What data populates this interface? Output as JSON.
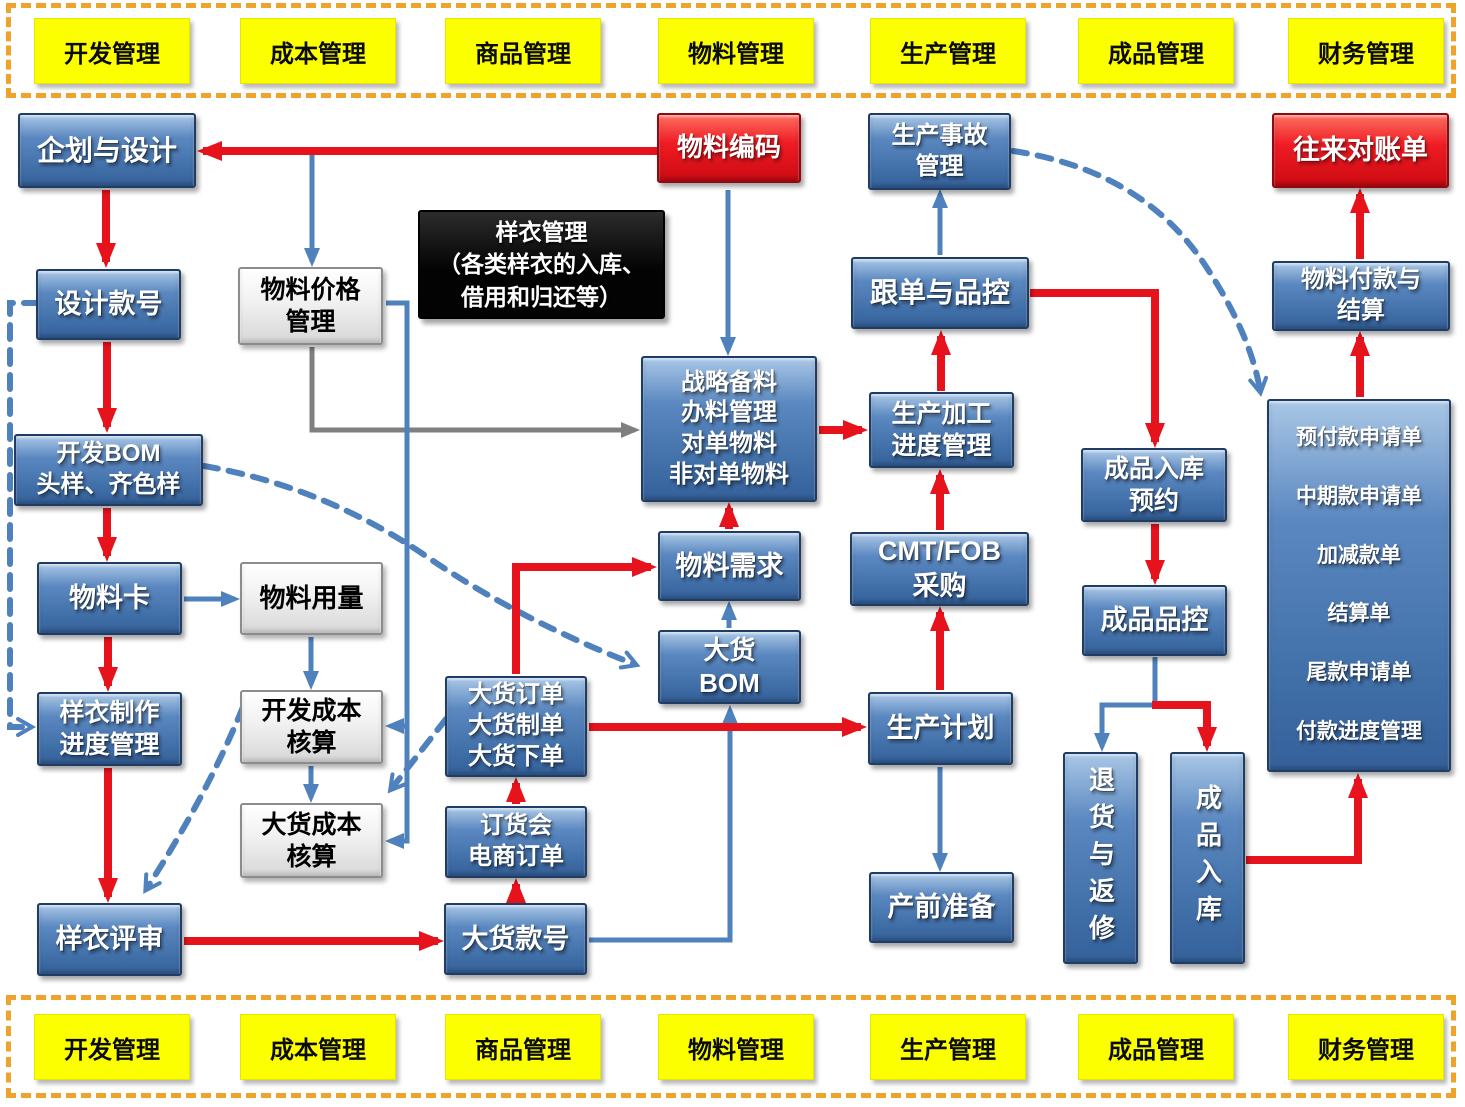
{
  "colors": {
    "red": "#e6131d",
    "blue": "#4f81bd",
    "gray": "#7f7f7f",
    "band": "#f0a32a",
    "box_blue": "#4272ab",
    "box_red": "#ef1c24",
    "box_yellow": "#fcff00"
  },
  "bands": {
    "labels": [
      "开发管理",
      "成本管理",
      "商品管理",
      "物料管理",
      "生产管理",
      "成品管理",
      "财务管理"
    ]
  },
  "nodes": {
    "planning_design": {
      "label": "企划与设计"
    },
    "material_code": {
      "label": "物料编码"
    },
    "production_accident": {
      "label": "生产事故\n管理"
    },
    "reconciliation": {
      "label": "往来对账单"
    },
    "sample_garment_note": {
      "label": "样衣管理\n（各类样衣的入库、\n借用和归还等）"
    },
    "design_style_no": {
      "label": "设计款号"
    },
    "material_price": {
      "label": "物料价格\n管理"
    },
    "merchandising_qc": {
      "label": "跟单与品控"
    },
    "material_payment": {
      "label": "物料付款与\n结算"
    },
    "strategic_material": {
      "label": "战略备料\n办料管理\n对单物料\n非对单物料"
    },
    "production_progress": {
      "label": "生产加工\n进度管理"
    },
    "dev_bom": {
      "label": "开发BOM\n头样、齐色样"
    },
    "fg_inbound_booking": {
      "label": "成品入库\n预约"
    },
    "cmt_fob": {
      "label": "CMT/FOB\n采购"
    },
    "material_demand": {
      "label": "物料需求"
    },
    "material_card": {
      "label": "物料卡"
    },
    "material_usage": {
      "label": "物料用量"
    },
    "fg_qc": {
      "label": "成品品控"
    },
    "bulk_bom": {
      "label": "大货\nBOM"
    },
    "sample_progress": {
      "label": "样衣制作\n进度管理"
    },
    "dev_cost": {
      "label": "开发成本\n核算"
    },
    "bulk_order": {
      "label": "大货订单\n大货制单\n大货下单"
    },
    "production_plan": {
      "label": "生产计划"
    },
    "bulk_cost": {
      "label": "大货成本\n核算"
    },
    "order_fair": {
      "label": "订货会\n电商订单"
    },
    "returns_repair": {
      "label": "退货与返修"
    },
    "fg_inbound": {
      "label": "成品入库"
    },
    "pre_production": {
      "label": "产前准备"
    },
    "sample_review": {
      "label": "样衣评审"
    },
    "bulk_style_no": {
      "label": "大货款号"
    },
    "payment_list": {
      "items": [
        "预付款申请单",
        "中期款申请单",
        "加减款单",
        "结算单",
        "尾款申请单",
        "付款进度管理"
      ]
    }
  }
}
